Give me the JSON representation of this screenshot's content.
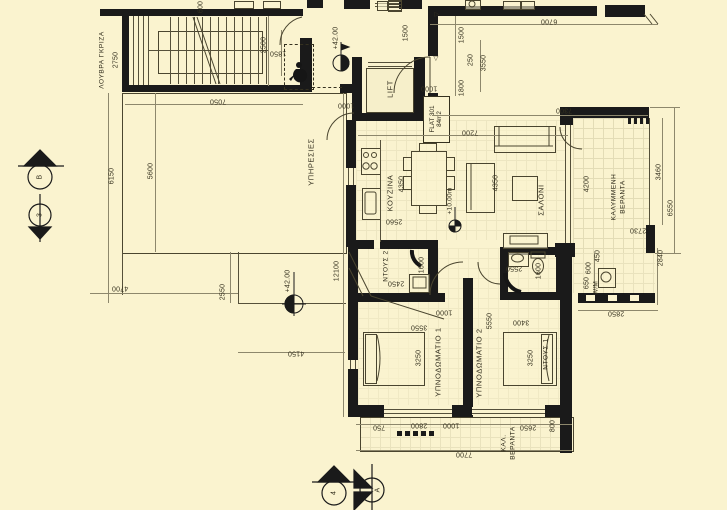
{
  "palette": {
    "background": "#faf3cf",
    "walls": "#1a1a1a",
    "lines": "#55503a",
    "grid": "#e3dcb6",
    "text": "#35311f"
  },
  "flat": {
    "name": "FLAT 301",
    "area": "84m2"
  },
  "rooms": {
    "services": "ΥΠΗΡΕΣΙΕΣ",
    "kitchen": "ΚΟΥΖΙΝΑ",
    "living": "ΣΑΛΟΝΙ",
    "bedroom1": "ΥΠΝΟΔΩΜΑΤΙΟ 1",
    "bedroom2": "ΥΠΝΟΔΩΜΑΤΙΟ 2",
    "shower_hall": "ΝΤΟΥΣ 2",
    "shower_ensuite": "ΝΤΟΥΣ 1",
    "lift": "LIFT",
    "louvres": "ΛΟΥΒΡΑ ΓΚΡΙΖΑ",
    "covered_veranda_1": "ΚΑΛΥΜΜΕΝΗ",
    "covered_veranda_2": "ΒΕΡΑΝΤΑ",
    "cal_veranda_1": "ΚΑΛ.",
    "cal_veranda_2": "ΒΕΡΑΝΤΑ",
    "washing_machine": "W/M"
  },
  "levels": {
    "entry": "+42.00",
    "terrace": "+42.00",
    "salon": "+10.00m"
  },
  "markers": {
    "section_b": "B",
    "section_3": "3",
    "section_4": "4",
    "section_a": "A"
  },
  "glyphs": {
    "tri_right": "▷",
    "tri_down": "▽"
  },
  "dims": {
    "louvra": "2750",
    "stair600": "600",
    "stair2500": "2500",
    "stair1850": "1850",
    "stair7050": "7050",
    "left6150": "6150",
    "left5600": "5600",
    "left4700": "4700",
    "terr2550": "2550",
    "terr4150": "4150",
    "left12100": "12100",
    "e1500": "1500",
    "e1000a": "1000",
    "e1000b": "1000",
    "s1500": "1500",
    "s250": "250",
    "s3550": "3550",
    "s1800": "1800",
    "top6700": "6700",
    "w7300": "7300",
    "w7200": "7200",
    "k4350": "4350",
    "k2560": "2560",
    "l4350": "4350",
    "v4200": "4200",
    "v3460": "3460",
    "v6550": "6550",
    "v2730": "2730",
    "v450": "450",
    "u600": "600",
    "u650": "650",
    "u2840": "2840",
    "u2850": "2850",
    "sh2450": "2450",
    "sh1600": "1600",
    "b2b2550": "2550",
    "b2b1600": "1600",
    "h1000": "1000",
    "b3550": "3550",
    "m5550": "5550",
    "b3400": "3400",
    "b1_3250": "3250",
    "b2_3250": "3250",
    "bot750": "750",
    "bot2800": "2800",
    "bot1000": "1000",
    "bot2650": "2650",
    "bot800": "800",
    "bot7700": "7700"
  }
}
